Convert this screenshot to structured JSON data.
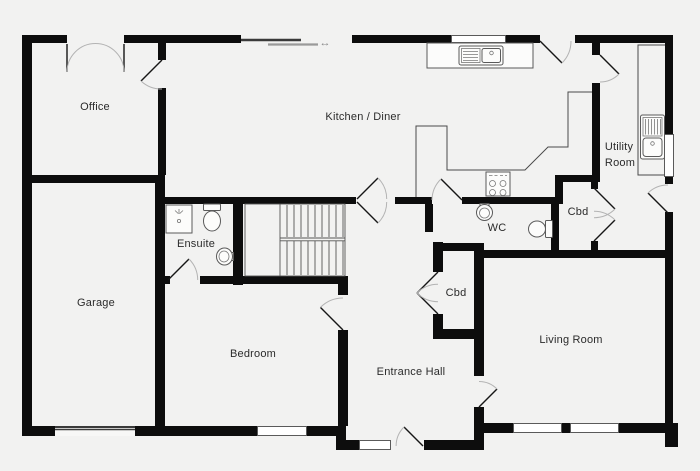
{
  "diagram": {
    "type": "floor-plan"
  },
  "rooms": [
    {
      "id": "office",
      "label": "Office"
    },
    {
      "id": "kitchen-diner",
      "label": "Kitchen / Diner"
    },
    {
      "id": "utility-room",
      "label": "Utility Room",
      "label_lines": [
        "Utility",
        "Room"
      ]
    },
    {
      "id": "garage",
      "label": "Garage"
    },
    {
      "id": "ensuite",
      "label": "Ensuite"
    },
    {
      "id": "wc",
      "label": "WC"
    },
    {
      "id": "cupboard-upper",
      "label": "Cbd"
    },
    {
      "id": "cupboard-hall",
      "label": "Cbd"
    },
    {
      "id": "bedroom",
      "label": "Bedroom"
    },
    {
      "id": "entrance-hall",
      "label": "Entrance Hall"
    },
    {
      "id": "living-room",
      "label": "Living Room"
    }
  ],
  "symbols": {
    "sliding_door_arrow": "↔"
  },
  "fixtures": [
    "kitchen-sink-drainer",
    "hob-four-burner",
    "utility-sink-drainer",
    "wc-basin",
    "wc-toilet",
    "ensuite-shower",
    "ensuite-toilet",
    "ensuite-basin",
    "staircase",
    "kitchen-counter",
    "utility-counter"
  ],
  "openings": {
    "windows": 6,
    "external_doors": 4,
    "internal_doors": 8,
    "double_doors": [
      "office-french-doors",
      "cupboard-upper-bifold",
      "cupboard-hall-bifold"
    ],
    "sliding_doors": 1,
    "garage_door": 1
  },
  "colors": {
    "wall": "#0d0d0d",
    "background": "#f2f2f1",
    "counter_line": "#4a4a4a",
    "swing_arc": "#b3b3b3",
    "window_fill": "#ffffff"
  }
}
